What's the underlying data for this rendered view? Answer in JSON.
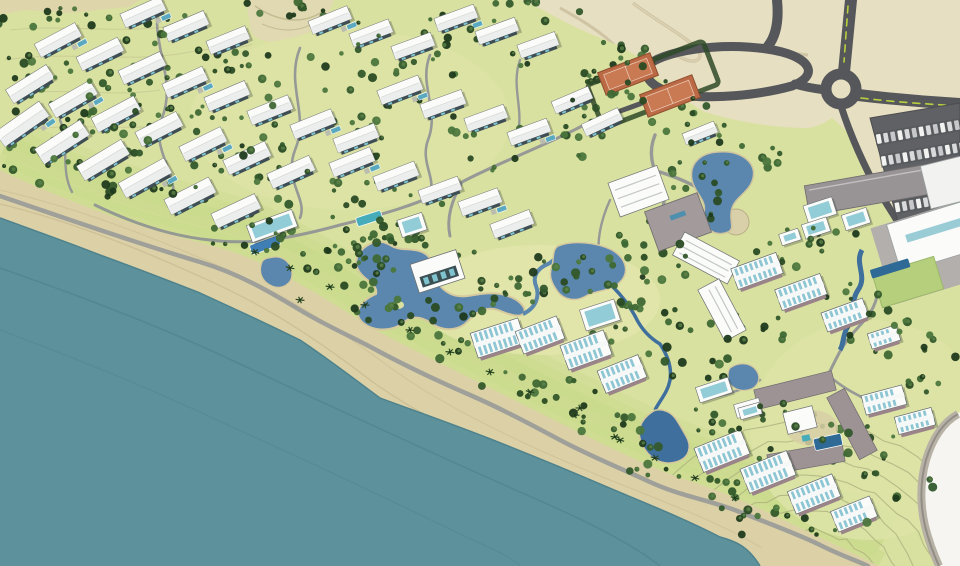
{
  "scene": {
    "type": "resort-masterplan-aerial-render",
    "canvas": {
      "width": 960,
      "height": 566
    },
    "feature_inventory": [
      "ocean",
      "beach-sand",
      "coastal-promenade",
      "desert",
      "resort-grounds",
      "contour-lines",
      "road-network",
      "roundabout",
      "entry-loop-road",
      "tennis-courts",
      "parking-lot",
      "villa-cluster",
      "beachfront-condo-rows",
      "hotel-complex",
      "arrival-pavilions",
      "service-building",
      "conference-center",
      "courtyard-hotel",
      "central-lagoon",
      "entry-lake",
      "east-pond",
      "beach-pond",
      "streams",
      "swimming-pools",
      "palm-trees",
      "white-margin"
    ]
  },
  "palette": {
    "desert": "#e7dfc1",
    "desert_band": "#ded5ab",
    "ocean": "#5d929c",
    "ocean_streak": "#51838d",
    "sand": "#dcd0a6",
    "sand_line": "#cabd94",
    "green": "#d9e1a0",
    "green_bright": "#c7da8a",
    "green_pale": "#e4e6ac",
    "courtyard_green": "#b6cf7c",
    "contour": "#a9ae7c",
    "road_dark": "#55575a",
    "road_median": "#b9cf3e",
    "path_grey": "#8f9294",
    "promenade": "#9b9d99",
    "desert_track": "#cfc5a4",
    "building_white": "#fbfcfa",
    "building_edge": "#6b7072",
    "facade_dark": "#3f4e55",
    "condo_stripe": "#8ec6d4",
    "condo_facade": "#9b8489",
    "grey_roof": "#a29a9b",
    "service_roof": "#989395",
    "conference_apron": "#b3afac",
    "glass_teal": "#7fc3cf",
    "lagoon": "#5b87ae",
    "stream": "#3f6f9c",
    "pool_blue": "#3f7fb5",
    "pool_dark": "#2e6a95",
    "pool_aqua": "#46acba",
    "tennis_court": "#bc6a45",
    "tennis_inner": "#c97a52",
    "tennis_edge": "#8d4f30",
    "parking_asphalt": "#5f6164",
    "car_light": "#f2f3f1",
    "tree_greens": [
      "#1f3a1c",
      "#2a4b24",
      "#33582b",
      "#3f6834",
      "#4b763d"
    ],
    "palm": "#2c4a26",
    "white_margin": "#f6f5f1"
  },
  "features": {
    "seed": 20240511,
    "villas": [
      [
        143,
        12,
        44,
        15,
        -24
      ],
      [
        186,
        26,
        44,
        15,
        -23
      ],
      [
        228,
        40,
        42,
        14,
        -22
      ],
      [
        330,
        20,
        42,
        14,
        -22
      ],
      [
        371,
        33,
        42,
        14,
        -21
      ],
      [
        413,
        46,
        42,
        14,
        -20
      ],
      [
        456,
        18,
        42,
        14,
        -20
      ],
      [
        497,
        31,
        42,
        14,
        -20
      ],
      [
        538,
        45,
        40,
        14,
        -20
      ],
      [
        58,
        40,
        46,
        15,
        -28
      ],
      [
        100,
        54,
        46,
        15,
        -26
      ],
      [
        142,
        68,
        46,
        15,
        -25
      ],
      [
        185,
        82,
        44,
        15,
        -24
      ],
      [
        227,
        96,
        44,
        15,
        -23
      ],
      [
        270,
        110,
        44,
        15,
        -22
      ],
      [
        313,
        124,
        44,
        15,
        -22
      ],
      [
        356,
        138,
        44,
        15,
        -21
      ],
      [
        30,
        84,
        48,
        16,
        -32
      ],
      [
        73,
        99,
        48,
        16,
        -30
      ],
      [
        116,
        114,
        48,
        16,
        -28
      ],
      [
        159,
        129,
        46,
        16,
        -27
      ],
      [
        203,
        144,
        46,
        16,
        -26
      ],
      [
        247,
        158,
        46,
        16,
        -25
      ],
      [
        291,
        172,
        46,
        16,
        -24
      ],
      [
        22,
        124,
        54,
        18,
        -35
      ],
      [
        62,
        142,
        54,
        18,
        -33
      ],
      [
        103,
        160,
        52,
        17,
        -31
      ],
      [
        145,
        178,
        52,
        17,
        -29
      ],
      [
        190,
        196,
        50,
        17,
        -27
      ],
      [
        236,
        211,
        48,
        16,
        -25
      ],
      [
        400,
        90,
        44,
        15,
        -21
      ],
      [
        443,
        104,
        44,
        15,
        -20
      ],
      [
        486,
        118,
        42,
        14,
        -20
      ],
      [
        529,
        132,
        42,
        14,
        -20
      ],
      [
        572,
        100,
        40,
        13,
        -23
      ],
      [
        602,
        122,
        40,
        13,
        -25
      ],
      [
        352,
        162,
        44,
        15,
        -22
      ],
      [
        396,
        176,
        44,
        15,
        -21
      ],
      [
        440,
        190,
        42,
        14,
        -20
      ],
      [
        480,
        202,
        42,
        15,
        -20
      ],
      [
        512,
        224,
        42,
        15,
        -21
      ],
      [
        700,
        133,
        34,
        12,
        -22
      ]
    ],
    "condos": [
      [
        498,
        338,
        50,
        26,
        -18
      ],
      [
        540,
        335,
        44,
        24,
        -21
      ],
      [
        586,
        350,
        46,
        26,
        -20
      ],
      [
        622,
        374,
        44,
        24,
        -22
      ],
      [
        757,
        271,
        48,
        22,
        -20
      ],
      [
        801,
        292,
        48,
        22,
        -20
      ],
      [
        845,
        315,
        44,
        20,
        -20
      ],
      [
        884,
        337,
        30,
        16,
        -18
      ],
      [
        722,
        451,
        50,
        26,
        -22
      ],
      [
        768,
        472,
        50,
        26,
        -22
      ],
      [
        814,
        494,
        48,
        24,
        -22
      ],
      [
        854,
        514,
        42,
        22,
        -22
      ],
      [
        884,
        400,
        42,
        20,
        -15
      ],
      [
        915,
        421,
        38,
        18,
        -15
      ]
    ],
    "pavilions": [
      [
        820,
        210,
        30,
        18,
        -18
      ],
      [
        856,
        219,
        26,
        16,
        -18
      ],
      [
        816,
        228,
        26,
        15,
        -18
      ],
      [
        790,
        237,
        20,
        12,
        -18
      ],
      [
        714,
        390,
        34,
        16,
        -18
      ],
      [
        750,
        411,
        22,
        12,
        -16
      ],
      [
        600,
        315,
        36,
        22,
        -18
      ],
      [
        272,
        226,
        48,
        18,
        -20
      ],
      [
        412,
        225,
        26,
        18,
        -18
      ]
    ],
    "tennis_courts": [
      [
        628,
        74,
        56,
        24,
        -21
      ],
      [
        670,
        96,
        56,
        24,
        -21
      ]
    ],
    "parking": {
      "lot": [
        [
          870,
          118
        ],
        [
          960,
          103
        ],
        [
          960,
          212
        ],
        [
          900,
          230
        ]
      ],
      "rows": [
        [
          918,
          132,
          -10,
          12
        ],
        [
          923,
          154,
          -10,
          12
        ],
        [
          928,
          178,
          -10,
          12
        ],
        [
          933,
          201,
          -10,
          11
        ]
      ]
    },
    "tree_clusters": [
      [
        95,
        22,
        100,
        16,
        20
      ],
      [
        300,
        8,
        60,
        10,
        9
      ],
      [
        430,
        30,
        90,
        16,
        12
      ],
      [
        520,
        12,
        60,
        12,
        9
      ],
      [
        40,
        70,
        45,
        28,
        14
      ],
      [
        90,
        90,
        70,
        35,
        20
      ],
      [
        170,
        60,
        80,
        30,
        16
      ],
      [
        250,
        80,
        80,
        30,
        16
      ],
      [
        340,
        70,
        70,
        28,
        12
      ],
      [
        470,
        60,
        60,
        24,
        10
      ],
      [
        60,
        130,
        60,
        28,
        16
      ],
      [
        140,
        115,
        70,
        28,
        14
      ],
      [
        230,
        130,
        80,
        30,
        16
      ],
      [
        320,
        145,
        70,
        28,
        14
      ],
      [
        410,
        125,
        60,
        26,
        10
      ],
      [
        500,
        145,
        60,
        26,
        10
      ],
      [
        40,
        165,
        50,
        24,
        12
      ],
      [
        130,
        175,
        70,
        26,
        14
      ],
      [
        220,
        190,
        70,
        26,
        14
      ],
      [
        310,
        195,
        60,
        24,
        10
      ],
      [
        400,
        200,
        60,
        24,
        10
      ],
      [
        240,
        235,
        50,
        18,
        9
      ],
      [
        320,
        255,
        55,
        20,
        10
      ],
      [
        390,
        235,
        45,
        18,
        9
      ],
      [
        620,
        85,
        55,
        46,
        40
      ],
      [
        690,
        120,
        40,
        28,
        13
      ],
      [
        580,
        135,
        35,
        22,
        9
      ],
      [
        420,
        285,
        85,
        50,
        28
      ],
      [
        360,
        250,
        45,
        22,
        11
      ],
      [
        490,
        300,
        45,
        25,
        11
      ],
      [
        545,
        280,
        50,
        30,
        13
      ],
      [
        610,
        280,
        45,
        30,
        13
      ],
      [
        660,
        250,
        45,
        35,
        15
      ],
      [
        700,
        190,
        42,
        38,
        17
      ],
      [
        745,
        155,
        35,
        22,
        9
      ],
      [
        640,
        330,
        55,
        30,
        15
      ],
      [
        700,
        355,
        45,
        28,
        11
      ],
      [
        745,
        330,
        45,
        25,
        11
      ],
      [
        790,
        250,
        35,
        22,
        9
      ],
      [
        830,
        238,
        30,
        20,
        8
      ],
      [
        862,
        310,
        40,
        35,
        13
      ],
      [
        900,
        332,
        35,
        28,
        9
      ],
      [
        930,
        370,
        30,
        25,
        8
      ],
      [
        790,
        430,
        60,
        40,
        17
      ],
      [
        730,
        420,
        40,
        25,
        9
      ],
      [
        860,
        450,
        45,
        30,
        11
      ],
      [
        900,
        480,
        40,
        28,
        9
      ],
      [
        840,
        530,
        45,
        25,
        9
      ],
      [
        560,
        400,
        40,
        22,
        9
      ],
      [
        610,
        432,
        40,
        22,
        9
      ],
      [
        660,
        465,
        35,
        20,
        8
      ],
      [
        710,
        490,
        40,
        22,
        8
      ],
      [
        770,
        520,
        40,
        22,
        8
      ],
      [
        280,
        225,
        35,
        15,
        7
      ],
      [
        360,
        300,
        40,
        16,
        7
      ],
      [
        440,
        345,
        40,
        16,
        7
      ],
      [
        520,
        385,
        40,
        16,
        7
      ]
    ],
    "palms": [
      [
        255,
        252
      ],
      [
        290,
        268
      ],
      [
        330,
        287
      ],
      [
        365,
        305
      ],
      [
        410,
        330
      ],
      [
        450,
        352
      ],
      [
        490,
        372
      ],
      [
        530,
        392
      ],
      [
        575,
        415
      ],
      [
        615,
        437
      ],
      [
        655,
        458
      ],
      [
        695,
        478
      ],
      [
        735,
        498
      ],
      [
        580,
        408
      ],
      [
        620,
        440
      ],
      [
        300,
        300
      ]
    ],
    "contour_arcs": {
      "cx": 805,
      "cy": 615,
      "radii": [
        85,
        103,
        121,
        139,
        157,
        175,
        193
      ],
      "a0": 198,
      "a1": 338
    }
  }
}
